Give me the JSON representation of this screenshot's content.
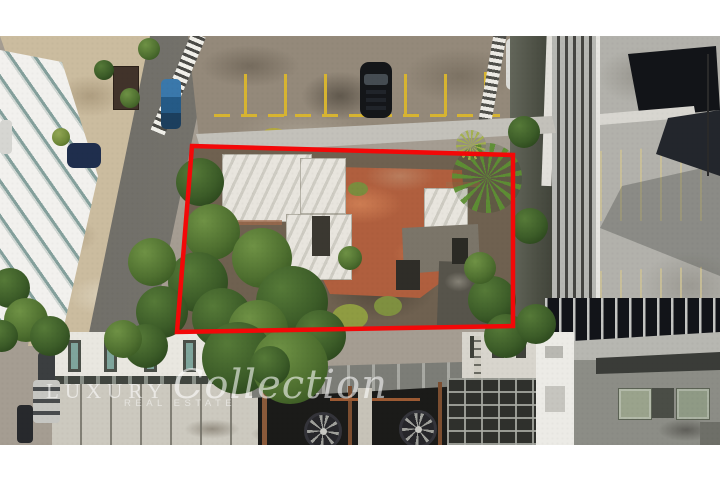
{
  "watermark": {
    "brand_prefix": "LUXURY",
    "brand_script": "Collection",
    "tagline": "REAL ESTATE"
  },
  "boundary": {
    "color": "#f30808"
  },
  "frame": {
    "margin_color": "#ffffff"
  },
  "scene": {
    "description": "aerial drone photo of an urban lot outlined in red"
  }
}
